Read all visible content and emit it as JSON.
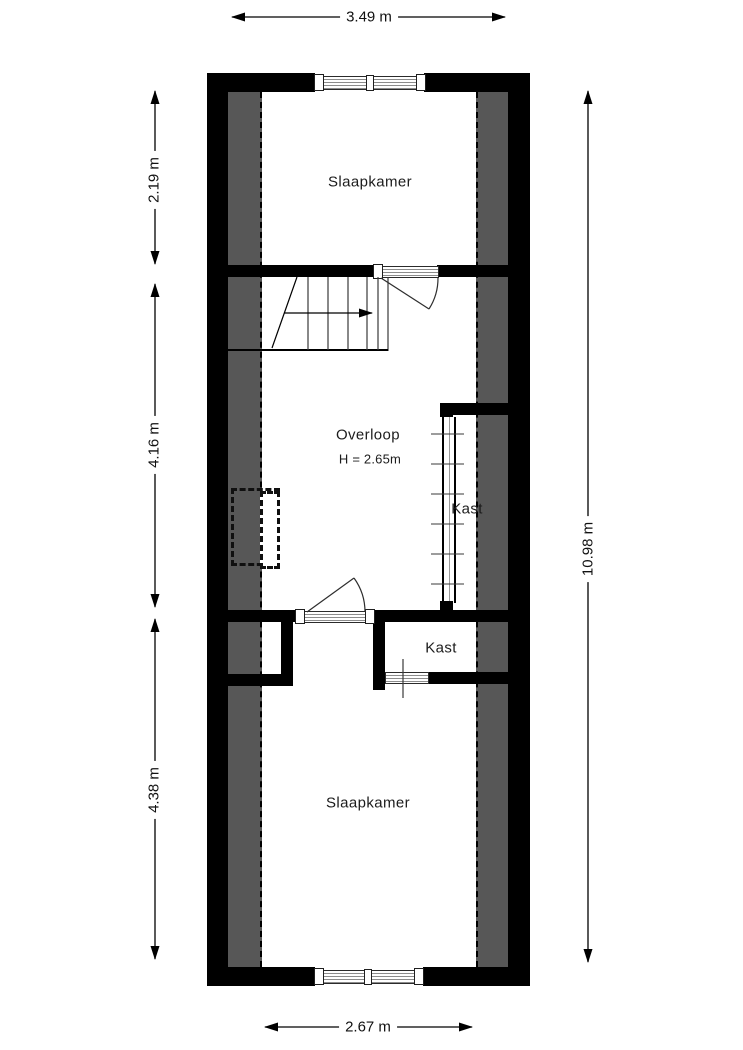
{
  "rooms": {
    "bedroom_top": {
      "label": "Slaapkamer"
    },
    "landing": {
      "label": "Overloop",
      "height_note": "H = 2.65m"
    },
    "closet_built_in": {
      "label": "Kast"
    },
    "closet_room": {
      "label": "Kast"
    },
    "bedroom_bottom": {
      "label": "Slaapkamer"
    }
  },
  "dimensions": {
    "top_width": "3.49 m",
    "left_upper": "2.19 m",
    "left_middle": "4.16 m",
    "left_lower": "4.38 m",
    "right_total": "10.98 m",
    "bottom_width": "2.67 m"
  },
  "colors": {
    "wall": "#000000",
    "sloped_attic_zone": "#575757",
    "floor": "#ffffff"
  }
}
